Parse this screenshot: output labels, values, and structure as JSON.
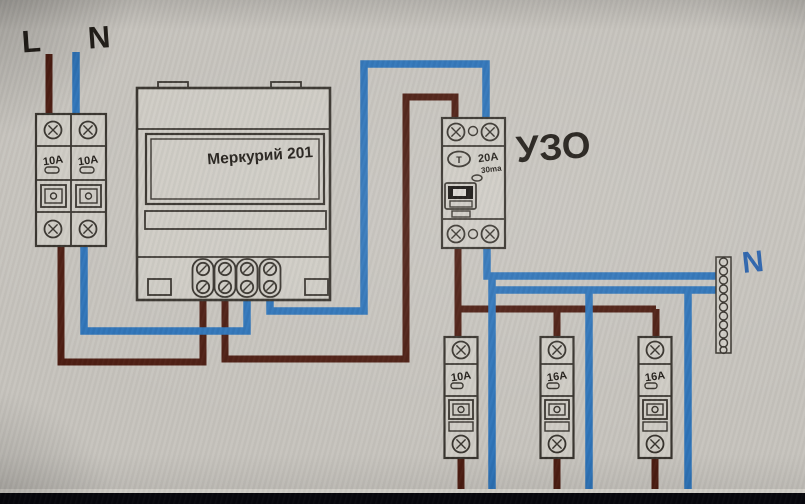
{
  "colors": {
    "background": "#c7c4be",
    "outline": "#38342e",
    "device_fill": "#cfccc5",
    "phase_wire": "#4d1d12",
    "neutral_wire": "#2e74b9",
    "label_text": "#211d18",
    "neutral_label": "#2b63ad",
    "letterbox": "#07070d"
  },
  "input_labels": {
    "phase": "L",
    "neutral": "N"
  },
  "main_breaker": {
    "pole1_rating": "10A",
    "pole2_rating": "10A"
  },
  "meter": {
    "name": "Меркурий 201"
  },
  "rcd": {
    "label": "УЗО",
    "rating": "20A",
    "leakage_current": "30ma",
    "test_button": "T"
  },
  "neutral_bus": {
    "label": "N"
  },
  "branch_breakers": [
    {
      "rating": "10A"
    },
    {
      "rating": "16A"
    },
    {
      "rating": "16A"
    }
  ]
}
